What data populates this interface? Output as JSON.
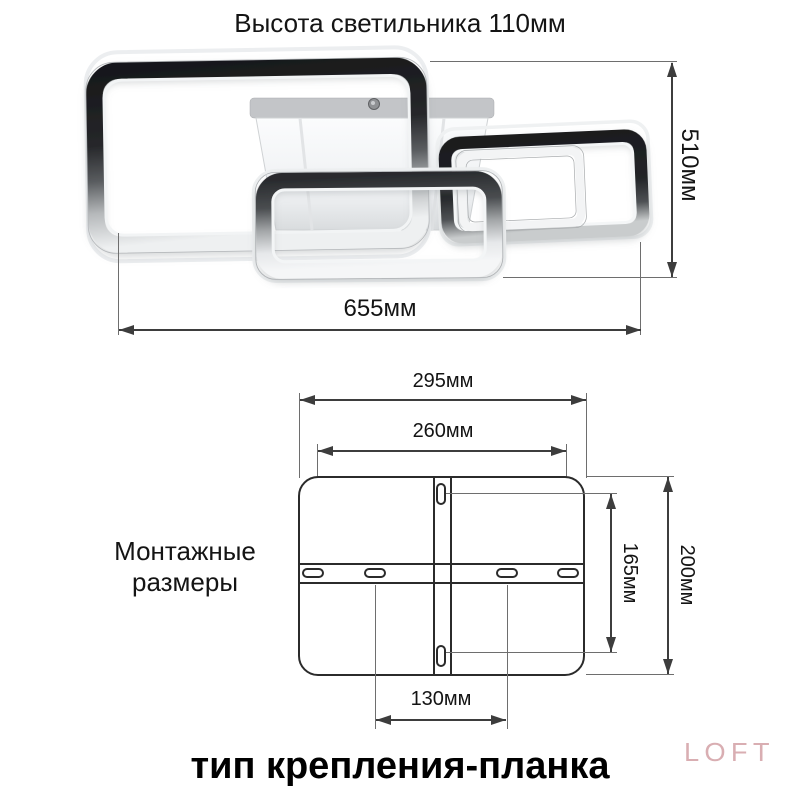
{
  "top_diagram": {
    "title": "Высота светильника 110мм",
    "width_dim_label": "655мм",
    "height_dim_label": "510мм"
  },
  "mounting_diagram": {
    "section_label_line1": "Монтажные",
    "section_label_line2": "размеры",
    "plate_width_label": "295мм",
    "slot_span_width_label": "260мм",
    "inner_slot_span_label": "130мм",
    "slot_span_height_label": "165мм",
    "plate_height_label": "200мм"
  },
  "footer": {
    "mount_type_title": "тип крепления-планка",
    "watermark": "LOFT"
  },
  "colors": {
    "background": "#ffffff",
    "dimension_line": "#3d3d3d",
    "extension_line": "#6e6e6e",
    "plate_outline": "#2b2b2b",
    "text": "#141414",
    "watermark": "#d9aeb2"
  }
}
